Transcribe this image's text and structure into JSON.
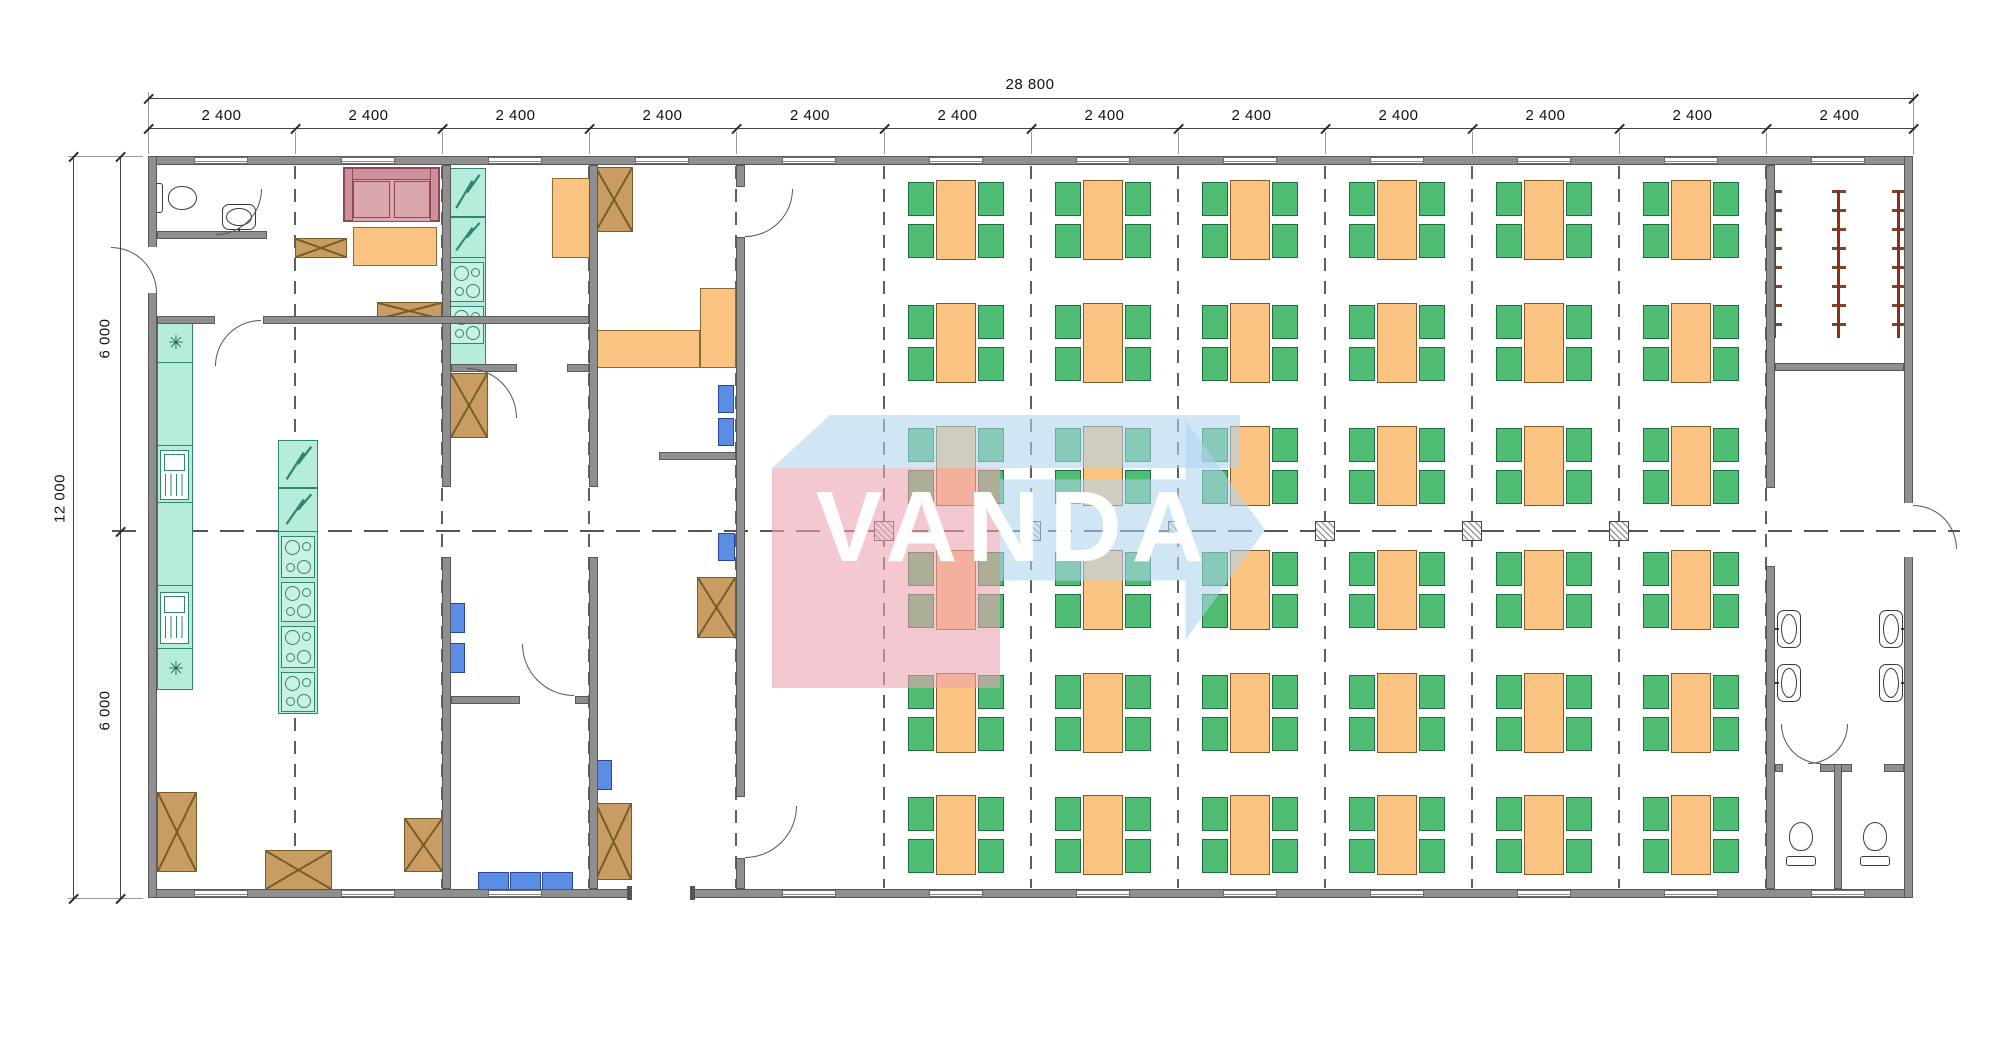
{
  "watermark": {
    "text": "VANDA",
    "pink": "#eca4b0",
    "blue": "#b0d4ee"
  },
  "dimensions": {
    "overall_width": "28 800",
    "bays": [
      "2 400",
      "2 400",
      "2 400",
      "2 400",
      "2 400",
      "2 400",
      "2 400",
      "2 400",
      "2 400",
      "2 400",
      "2 400",
      "2 400"
    ],
    "overall_height": "12 000",
    "height_halves": [
      "6 000",
      "6 000"
    ]
  },
  "colors": {
    "wall": "#8f8f8f",
    "wall_stroke": "#585858",
    "appliance_teal": "#b6ecdc",
    "appliance_stroke": "#2f8673",
    "table_orange": "#fbc381",
    "table_stroke": "#7c5b26",
    "chair_green": "#4fbd74",
    "chair_stroke": "#1d6e40",
    "sofa_pink": "#dba6ae",
    "cabinet_brown": "#c99c64",
    "seat_blue": "#5b8de4",
    "rack_red": "#8b2e1c",
    "grid_dash": "#5f5f5f",
    "dim_text": "#111111"
  },
  "plan": {
    "grid_x": [
      148,
      295,
      442,
      589,
      736,
      884,
      1031,
      1178,
      1325,
      1472,
      1619,
      1766,
      1913
    ],
    "dim": {
      "overall_y": 98,
      "seg_y": 128,
      "left_x": 73,
      "left2_x": 120,
      "top": 156,
      "bottom": 898,
      "mid": 531
    },
    "walls": [
      [
        148,
        156,
        1765,
        9
      ],
      [
        148,
        889,
        1765,
        9
      ],
      [
        148,
        156,
        9,
        742
      ],
      [
        1904,
        156,
        9,
        742
      ],
      [
        442,
        165,
        9,
        322
      ],
      [
        442,
        557,
        9,
        332
      ],
      [
        589,
        165,
        9,
        322
      ],
      [
        589,
        557,
        9,
        332
      ],
      [
        736,
        165,
        9,
        22
      ],
      [
        736,
        237,
        9,
        560
      ],
      [
        736,
        858,
        9,
        31
      ],
      [
        1766,
        165,
        9,
        323
      ],
      [
        1766,
        566,
        9,
        323
      ],
      [
        157,
        231,
        110,
        8
      ],
      [
        157,
        316,
        58,
        8
      ],
      [
        263,
        316,
        326,
        8
      ],
      [
        451,
        364,
        66,
        8
      ],
      [
        567,
        364,
        22,
        8
      ],
      [
        659,
        452,
        77,
        8
      ],
      [
        451,
        696,
        69,
        8
      ],
      [
        575,
        696,
        14,
        8
      ],
      [
        1775,
        363,
        129,
        8
      ],
      [
        1775,
        764,
        8,
        8
      ],
      [
        1820,
        764,
        32,
        8
      ],
      [
        1884,
        764,
        20,
        8
      ],
      [
        1834,
        764,
        8,
        125
      ]
    ],
    "window_centers_top": [
      221,
      368,
      515,
      662,
      809,
      956,
      1103,
      1250,
      1397,
      1544,
      1691,
      1838
    ],
    "window_centers_bottom": [
      221,
      368,
      515,
      809,
      956,
      1103,
      1250,
      1397,
      1544,
      1691,
      1838
    ],
    "bottom_door": {
      "x": 632,
      "w": 58
    },
    "right_door_gap": {
      "y": 503,
      "h": 54
    },
    "left_door_gap": {
      "y": 247,
      "h": 46
    },
    "gridlines_x": [
      295,
      442,
      589,
      736,
      884,
      1031,
      1178,
      1325,
      1472,
      1619,
      1766
    ],
    "markers_x": [
      884,
      1031,
      1178,
      1325,
      1472,
      1619
    ],
    "dining": {
      "columns_x": [
        956,
        1103,
        1250,
        1397,
        1544,
        1691
      ],
      "rows_y": [
        180,
        303,
        426,
        550,
        673,
        795
      ],
      "table": {
        "w": 40,
        "h": 80
      },
      "chair": {
        "w": 26,
        "h": 34
      }
    },
    "cabinets": [
      [
        295,
        238,
        52,
        20
      ],
      [
        377,
        302,
        65,
        18
      ],
      [
        450,
        373,
        38,
        65
      ],
      [
        595,
        167,
        38,
        65
      ],
      [
        697,
        577,
        39,
        61
      ],
      [
        157,
        792,
        40,
        80
      ],
      [
        265,
        850,
        67,
        40
      ],
      [
        404,
        818,
        39,
        54
      ],
      [
        595,
        803,
        37,
        77
      ]
    ],
    "blue_seats": [
      [
        718,
        385,
        16,
        28
      ],
      [
        718,
        418,
        16,
        28
      ],
      [
        718,
        533,
        17,
        28
      ],
      [
        448,
        603,
        17,
        30
      ],
      [
        448,
        643,
        17,
        30
      ],
      [
        592,
        760,
        20,
        30
      ],
      [
        478,
        872,
        31,
        18
      ],
      [
        510,
        872,
        31,
        18
      ],
      [
        542,
        872,
        31,
        18
      ]
    ],
    "counters": [
      [
        353,
        227,
        84,
        39
      ],
      [
        552,
        178,
        38,
        80
      ],
      [
        592,
        330,
        108,
        38
      ],
      [
        700,
        288,
        36,
        80
      ]
    ],
    "sofa": [
      343,
      167,
      97,
      55
    ],
    "teal": {
      "left_counter": [
        157,
        322,
        36,
        368
      ],
      "left_dividers_y": [
        362,
        445,
        502,
        585,
        648
      ],
      "sinks": [
        [
          160,
          450,
          29,
          50
        ],
        [
          160,
          592,
          29,
          52
        ]
      ],
      "asterisks": [
        [
          168,
          334
        ],
        [
          168,
          660
        ]
      ],
      "island": [
        278,
        440,
        40,
        274
      ],
      "island_fridges": [
        [
          278,
          440,
          40,
          48
        ],
        [
          278,
          488,
          40,
          44
        ]
      ],
      "island_stoves": [
        [
          281,
          536,
          34,
          42
        ],
        [
          281,
          582,
          34,
          40
        ],
        [
          281,
          626,
          34,
          42
        ],
        [
          281,
          672,
          34,
          40
        ]
      ],
      "column_fridges": [
        [
          448,
          168,
          38,
          49
        ],
        [
          448,
          217,
          38,
          41
        ]
      ],
      "column_stoves": [
        [
          450,
          262,
          34,
          40
        ],
        [
          450,
          306,
          34,
          38
        ]
      ],
      "column_base": [
        448,
        168,
        38,
        200
      ]
    },
    "basins": [
      {
        "x": 222,
        "y": 204,
        "facing": "down",
        "horiz": true
      },
      {
        "x": 1777,
        "y": 610,
        "facing": "right"
      },
      {
        "x": 1777,
        "y": 664,
        "facing": "right"
      },
      {
        "x": 1879,
        "y": 610,
        "facing": "left"
      },
      {
        "x": 1879,
        "y": 664,
        "facing": "left"
      }
    ],
    "toilets": [
      {
        "x": 160,
        "y": 176,
        "rot": 90
      },
      {
        "x": 1786,
        "y": 822,
        "rot": 0
      },
      {
        "x": 1860,
        "y": 822,
        "rot": 0
      }
    ],
    "racks": {
      "xs": [
        1775,
        1839,
        1899
      ],
      "y": 190,
      "h": 148
    },
    "doors": [
      [
        262,
        189,
        46,
        "br"
      ],
      [
        157,
        247,
        46,
        "tr"
      ],
      [
        215,
        320,
        46,
        "tl"
      ],
      [
        517,
        368,
        50,
        "tr"
      ],
      [
        736,
        189,
        48,
        "br"
      ],
      [
        736,
        806,
        52,
        "br"
      ],
      [
        522,
        644,
        52,
        "bl"
      ],
      [
        1913,
        505,
        44,
        "tr"
      ],
      [
        1781,
        724,
        40,
        "bl"
      ],
      [
        1848,
        724,
        40,
        "br"
      ]
    ]
  }
}
